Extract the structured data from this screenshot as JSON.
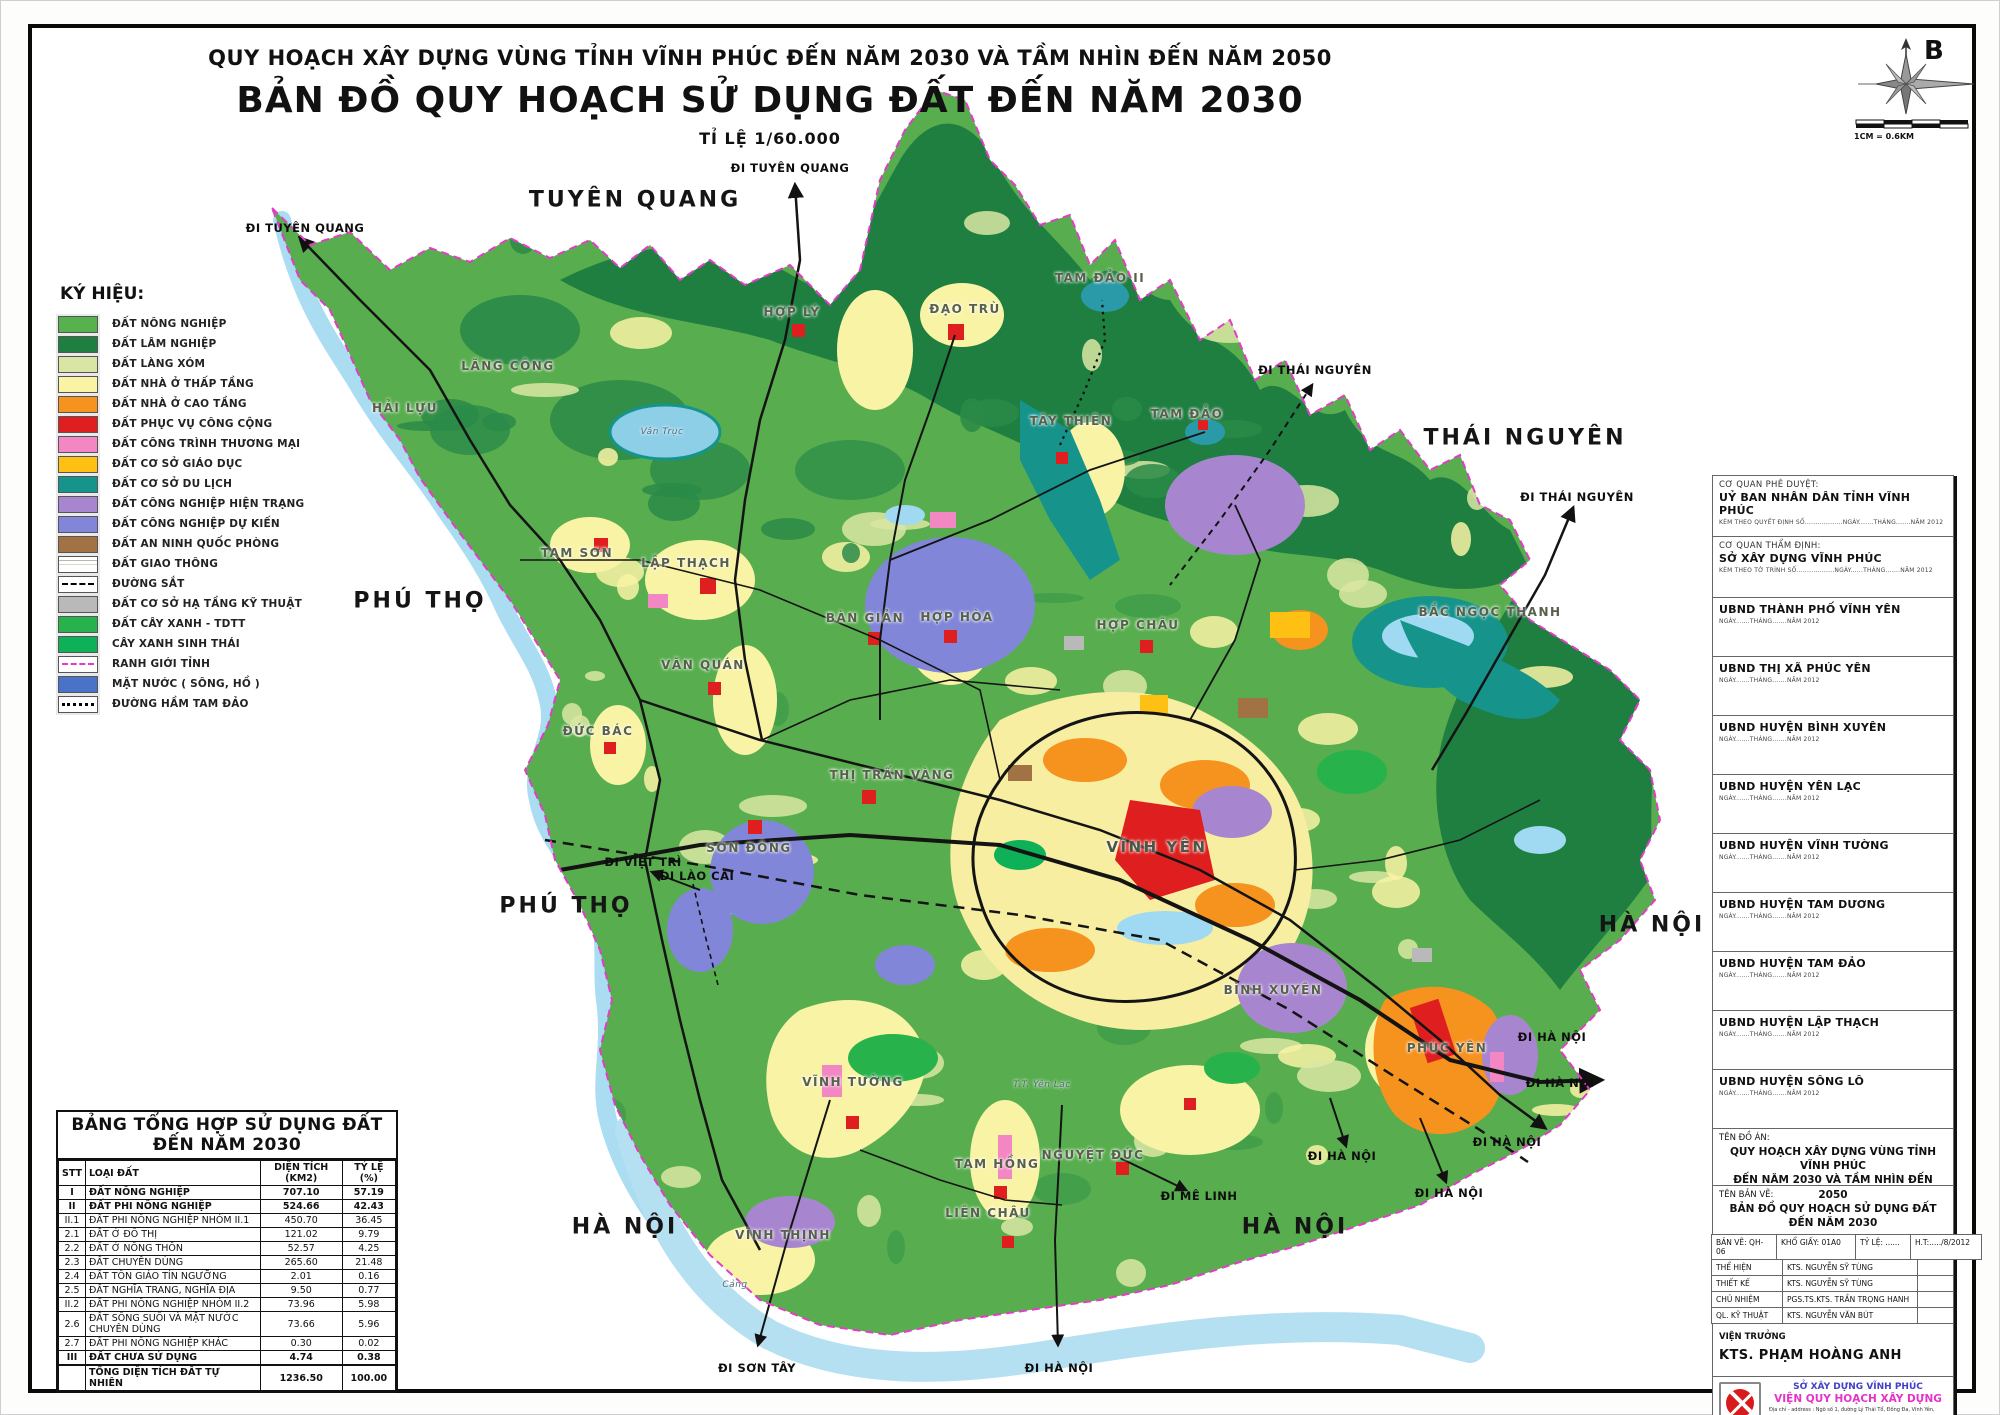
{
  "title": {
    "line1": "QUY HOẠCH XÂY DỰNG VÙNG TỈNH VĨNH PHÚC  ĐẾN NĂM 2030 VÀ TẦM NHÌN ĐẾN  NĂM 2050",
    "line2": "BẢN ĐỒ QUY HOẠCH SỬ DỤNG ĐẤT ĐẾN NĂM 2030",
    "line3": "TỈ LỆ 1/60.000"
  },
  "compass": {
    "north_label": "B",
    "scale_text": "1CM = 0.6KM"
  },
  "legend": {
    "title": "KÝ HIỆU:",
    "items": [
      {
        "label": "ĐẤT NÔNG NGHIỆP",
        "type": "fill",
        "color": "#57b14e"
      },
      {
        "label": "ĐẤT LÂM NGHIỆP",
        "type": "fill",
        "color": "#1e7f41"
      },
      {
        "label": "ĐẤT LÀNG XÓM",
        "type": "fill",
        "color": "#d9e6a3"
      },
      {
        "label": "ĐẤT NHÀ Ở THẤP TẦNG",
        "type": "fill",
        "color": "#f9f3a6"
      },
      {
        "label": "ĐẤT NHÀ Ở CAO TẦNG",
        "type": "fill",
        "color": "#f6921e"
      },
      {
        "label": "ĐẤT PHỤC VỤ CÔNG CỘNG",
        "type": "fill",
        "color": "#df1f1f"
      },
      {
        "label": "ĐẤT CÔNG TRÌNH THƯƠNG MẠI",
        "type": "fill",
        "color": "#f287c3"
      },
      {
        "label": "ĐẤT CƠ SỞ GIÁO DỤC",
        "type": "fill",
        "color": "#fdc013"
      },
      {
        "label": "ĐẤT CƠ SỞ DU LỊCH",
        "type": "fill",
        "color": "#16948c"
      },
      {
        "label": "ĐẤT CÔNG NGHIỆP HIỆN TRẠNG",
        "type": "fill",
        "color": "#a886cf"
      },
      {
        "label": "ĐẤT CÔNG NGHIỆP DỰ KIẾN",
        "type": "fill",
        "color": "#8186d8"
      },
      {
        "label": "ĐẤT AN NINH QUỐC PHÒNG",
        "type": "fill",
        "color": "#a07244"
      },
      {
        "label": "ĐẤT GIAO THÔNG",
        "type": "roads",
        "color": "#ffffff"
      },
      {
        "label": "ĐƯỜNG SẮT",
        "type": "rail",
        "color": "#000000"
      },
      {
        "label": "ĐẤT CƠ SỞ HẠ TẦNG KỸ THUẬT",
        "type": "fill",
        "color": "#b9b9b9"
      },
      {
        "label": "ĐẤT CÂY XANH - TDTT",
        "type": "fill",
        "color": "#27b24b"
      },
      {
        "label": "CÂY XANH SINH THÁI",
        "type": "fill",
        "color": "#0eb158"
      },
      {
        "label": "RANH GIỚI TỈNH",
        "type": "boundary",
        "color": "#e23cc8"
      },
      {
        "label": "MẶT NƯỚC ( SÔNG, HỒ )",
        "type": "fill",
        "color": "#4a72c8"
      },
      {
        "label": "ĐƯỜNG HẦM TAM ĐẢO",
        "type": "tunnel",
        "color": "#000000"
      }
    ]
  },
  "map": {
    "regions": [
      {
        "text": "TUYÊN QUANG",
        "x": 635,
        "y": 200
      },
      {
        "text": "THÁI NGUYÊN",
        "x": 1525,
        "y": 438
      },
      {
        "text": "PHÚ THỌ",
        "x": 420,
        "y": 601
      },
      {
        "text": "PHÚ THỌ",
        "x": 566,
        "y": 906
      },
      {
        "text": "HÀ NỘI",
        "x": 625,
        "y": 1227
      },
      {
        "text": "HÀ NỘI",
        "x": 1295,
        "y": 1227
      },
      {
        "text": "HÀ NỘI",
        "x": 1652,
        "y": 925
      }
    ],
    "directions": [
      {
        "text": "ĐI TUYÊN QUANG",
        "x": 305,
        "y": 228
      },
      {
        "text": "ĐI TUYÊN QUANG",
        "x": 790,
        "y": 168
      },
      {
        "text": "ĐI THÁI NGUYÊN",
        "x": 1315,
        "y": 370
      },
      {
        "text": "ĐI THÁI NGUYÊN",
        "x": 1577,
        "y": 497
      },
      {
        "text": "ĐI VIỆT TRÌ",
        "x": 643,
        "y": 862
      },
      {
        "text": "ĐI LÀO CAI",
        "x": 697,
        "y": 876
      },
      {
        "text": "ĐI MÊ LINH",
        "x": 1199,
        "y": 1196
      },
      {
        "text": "ĐI SƠN TÂY",
        "x": 757,
        "y": 1368
      },
      {
        "text": "ĐI HÀ NỘI",
        "x": 1059,
        "y": 1368
      },
      {
        "text": "ĐI HÀ NỘI",
        "x": 1552,
        "y": 1037
      },
      {
        "text": "ĐI HÀ NỘI",
        "x": 1560,
        "y": 1083
      },
      {
        "text": "ĐI HÀ NỘI",
        "x": 1507,
        "y": 1142
      },
      {
        "text": "ĐI HÀ NỘI",
        "x": 1342,
        "y": 1156
      },
      {
        "text": "ĐI HÀ NỘI",
        "x": 1449,
        "y": 1193
      }
    ],
    "towns": [
      {
        "text": "HẢI LỰU",
        "x": 405,
        "y": 408
      },
      {
        "text": "LÃNG CÔNG",
        "x": 508,
        "y": 366
      },
      {
        "text": "HỢP LÝ",
        "x": 792,
        "y": 312
      },
      {
        "text": "ĐẠO TRÙ",
        "x": 965,
        "y": 309
      },
      {
        "text": "TAM ĐẢO II",
        "x": 1100,
        "y": 278
      },
      {
        "text": "TÂY THIÊN",
        "x": 1071,
        "y": 421
      },
      {
        "text": "TAM ĐẢO",
        "x": 1187,
        "y": 414
      },
      {
        "text": "BẮC NGỌC THANH",
        "x": 1490,
        "y": 612
      },
      {
        "text": "TAM SƠN",
        "x": 577,
        "y": 553
      },
      {
        "text": "LẬP THẠCH",
        "x": 686,
        "y": 563
      },
      {
        "text": "VĂN QUÁN",
        "x": 703,
        "y": 665
      },
      {
        "text": "BÀN GIẢN",
        "x": 865,
        "y": 618
      },
      {
        "text": "HỢP HÒA",
        "x": 957,
        "y": 617
      },
      {
        "text": "HỢP CHÂU",
        "x": 1138,
        "y": 625
      },
      {
        "text": "ĐỨC BÁC",
        "x": 598,
        "y": 731
      },
      {
        "text": "SƠN ĐÔNG",
        "x": 749,
        "y": 848
      },
      {
        "text": "THỊ TRẤN VÀNG",
        "x": 892,
        "y": 775
      },
      {
        "text": "VĨNH YÊN",
        "x": 1157,
        "y": 847,
        "size": "big"
      },
      {
        "text": "BÌNH XUYÊN",
        "x": 1273,
        "y": 990
      },
      {
        "text": "PHÚC YÊN",
        "x": 1447,
        "y": 1048
      },
      {
        "text": "VĨNH TƯỜNG",
        "x": 853,
        "y": 1082
      },
      {
        "text": "VĨNH THỊNH",
        "x": 783,
        "y": 1235
      },
      {
        "text": "TAM HỒNG",
        "x": 997,
        "y": 1164
      },
      {
        "text": "NGUYỆT ĐỨC",
        "x": 1093,
        "y": 1155
      },
      {
        "text": "LIÊN CHÂU",
        "x": 988,
        "y": 1213
      },
      {
        "text": "T.T. Yên Lạc",
        "x": 1042,
        "y": 1085,
        "size": "minor"
      },
      {
        "text": "Vân Trục",
        "x": 662,
        "y": 432,
        "size": "minor"
      },
      {
        "text": "Cảng",
        "x": 735,
        "y": 1285,
        "size": "minor"
      }
    ]
  },
  "land_table": {
    "title": "BẢNG TỔNG HỢP SỬ DỤNG ĐẤT ĐẾN NĂM 2030",
    "columns": [
      "STT",
      "LOẠI ĐẤT",
      "DIỆN TÍCH (KM2)",
      "TỶ LỆ (%)"
    ],
    "rows": [
      {
        "stt": "I",
        "label": "ĐẤT NÔNG NGHIỆP",
        "area": "707.10",
        "pct": "57.19",
        "bold": true
      },
      {
        "stt": "II",
        "label": "ĐẤT PHI NÔNG NGHIỆP",
        "area": "524.66",
        "pct": "42.43",
        "bold": true
      },
      {
        "stt": "II.1",
        "label": "ĐẤT PHI NÔNG NGHIỆP NHÓM II.1",
        "area": "450.70",
        "pct": "36.45",
        "bold": false
      },
      {
        "stt": "2.1",
        "label": "ĐẤT Ở ĐÔ THỊ",
        "area": "121.02",
        "pct": "9.79",
        "bold": false
      },
      {
        "stt": "2.2",
        "label": "ĐẤT Ở NÔNG THÔN",
        "area": "52.57",
        "pct": "4.25",
        "bold": false
      },
      {
        "stt": "2.3",
        "label": "ĐẤT CHUYÊN DÙNG",
        "area": "265.60",
        "pct": "21.48",
        "bold": false
      },
      {
        "stt": "2.4",
        "label": "ĐẤT TÔN GIÁO TÍN NGƯỠNG",
        "area": "2.01",
        "pct": "0.16",
        "bold": false
      },
      {
        "stt": "2.5",
        "label": "ĐẤT NGHĨA TRANG, NGHĨA ĐỊA",
        "area": "9.50",
        "pct": "0.77",
        "bold": false
      },
      {
        "stt": "II.2",
        "label": "ĐẤT PHI NÔNG NGHIỆP NHÓM II.2",
        "area": "73.96",
        "pct": "5.98",
        "bold": false
      },
      {
        "stt": "2.6",
        "label": "ĐẤT SÔNG SUỐI VÀ MẶT NƯỚC CHUYÊN DÙNG",
        "area": "73.66",
        "pct": "5.96",
        "bold": false
      },
      {
        "stt": "2.7",
        "label": "ĐẤT PHI NÔNG NGHIỆP KHÁC",
        "area": "0.30",
        "pct": "0.02",
        "bold": false
      },
      {
        "stt": "III",
        "label": "ĐẤT CHƯA SỬ DỤNG",
        "area": "4.74",
        "pct": "0.38",
        "bold": true
      },
      {
        "stt": "",
        "label": "TỔNG DIỆN TÍCH ĐẤT TỰ NHIÊN",
        "area": "1236.50",
        "pct": "100.00",
        "bold": true,
        "total": true
      }
    ]
  },
  "sidebar": {
    "panels": [
      {
        "heading": "CƠ QUAN PHÊ DUYỆT:",
        "title": "UỶ BAN NHÂN DÂN TỈNH VĨNH PHÚC",
        "note": "KÈM THEO QUYẾT ĐỊNH SỐ..................NGÀY.......THÁNG.......NĂM 2012"
      },
      {
        "heading": "CƠ QUAN THẨM ĐỊNH:",
        "title": "SỞ XÂY DỰNG VĨNH PHÚC",
        "note": "KÈM THEO TỜ TRÌNH SỐ..................NGÀY......THÁNG.......NĂM 2012"
      },
      {
        "heading": "",
        "title": "UBND THÀNH PHỐ VĨNH YÊN",
        "note": "NGÀY.......THÁNG.......NĂM 2012"
      },
      {
        "heading": "",
        "title": "UBND THỊ XÃ PHÚC YÊN",
        "note": "NGÀY.......THÁNG.......NĂM 2012"
      },
      {
        "heading": "",
        "title": "UBND HUYỆN BÌNH XUYÊN",
        "note": "NGÀY.......THÁNG.......NĂM 2012"
      },
      {
        "heading": "",
        "title": "UBND HUYỆN YÊN LẠC",
        "note": "NGÀY.......THÁNG.......NĂM 2012"
      },
      {
        "heading": "",
        "title": "UBND HUYỆN VĨNH TƯỜNG",
        "note": "NGÀY.......THÁNG.......NĂM 2012"
      },
      {
        "heading": "",
        "title": "UBND HUYỆN TAM DƯƠNG",
        "note": "NGÀY.......THÁNG.......NĂM 2012"
      },
      {
        "heading": "",
        "title": "UBND HUYỆN TAM ĐẢO",
        "note": "NGÀY.......THÁNG.......NĂM 2012"
      },
      {
        "heading": "",
        "title": "UBND HUYỆN LẬP THẠCH",
        "note": "NGÀY.......THÁNG.......NĂM 2012"
      },
      {
        "heading": "",
        "title": "UBND HUYỆN SÔNG LÔ",
        "note": "NGÀY.......THÁNG.......NĂM 2012"
      }
    ],
    "project": {
      "label": "TÊN ĐỒ ÁN:",
      "name_line1": "QUY HOẠCH XÂY DỰNG VÙNG TỈNH VĨNH PHÚC",
      "name_line2": "ĐẾN NĂM 2030 VÀ TẦM NHÌN ĐẾN 2050"
    },
    "drawing": {
      "label": "TÊN BẢN VẼ:",
      "name": "BẢN ĐỒ QUY HOẠCH SỬ DỤNG ĐẤT ĐẾN NĂM 2030"
    },
    "meta": [
      "BẢN VẼ: QH-06",
      "KHỔ GIẤY: 01A0",
      "TỶ LỆ: ......",
      "H.T:...../8/2012"
    ],
    "credits": [
      {
        "role": "THỂ HIỆN",
        "name": "KTS. NGUYỄN SỸ TÙNG"
      },
      {
        "role": "THIẾT KẾ",
        "name": "KTS. NGUYỄN SỸ TÙNG"
      },
      {
        "role": "CHỦ NHIỆM",
        "name": "PGS.TS.KTS. TRẦN TRỌNG HANH"
      },
      {
        "role": "QL. KỸ THUẬT",
        "name": "KTS. NGUYỄN VĂN BÚT"
      }
    ],
    "director": {
      "role": "VIỆN TRƯỞNG",
      "name": "KTS. PHẠM HOÀNG ANH"
    },
    "org": {
      "line1": "SỞ XÂY DỰNG VĨNH PHÚC",
      "line2": "VIỆN QUY HOẠCH XÂY DỰNG",
      "address": "Địa chỉ - address : Ngõ số 1, đường Lý Thái Tổ, Đống Đa, Vĩnh Yên, Vĩnh Phúc",
      "tel": "Tel : 84 0211 - 3720.217",
      "fax": "Fax : 84 0211 - 3720.880",
      "logo_text": "VP.CPI"
    }
  }
}
